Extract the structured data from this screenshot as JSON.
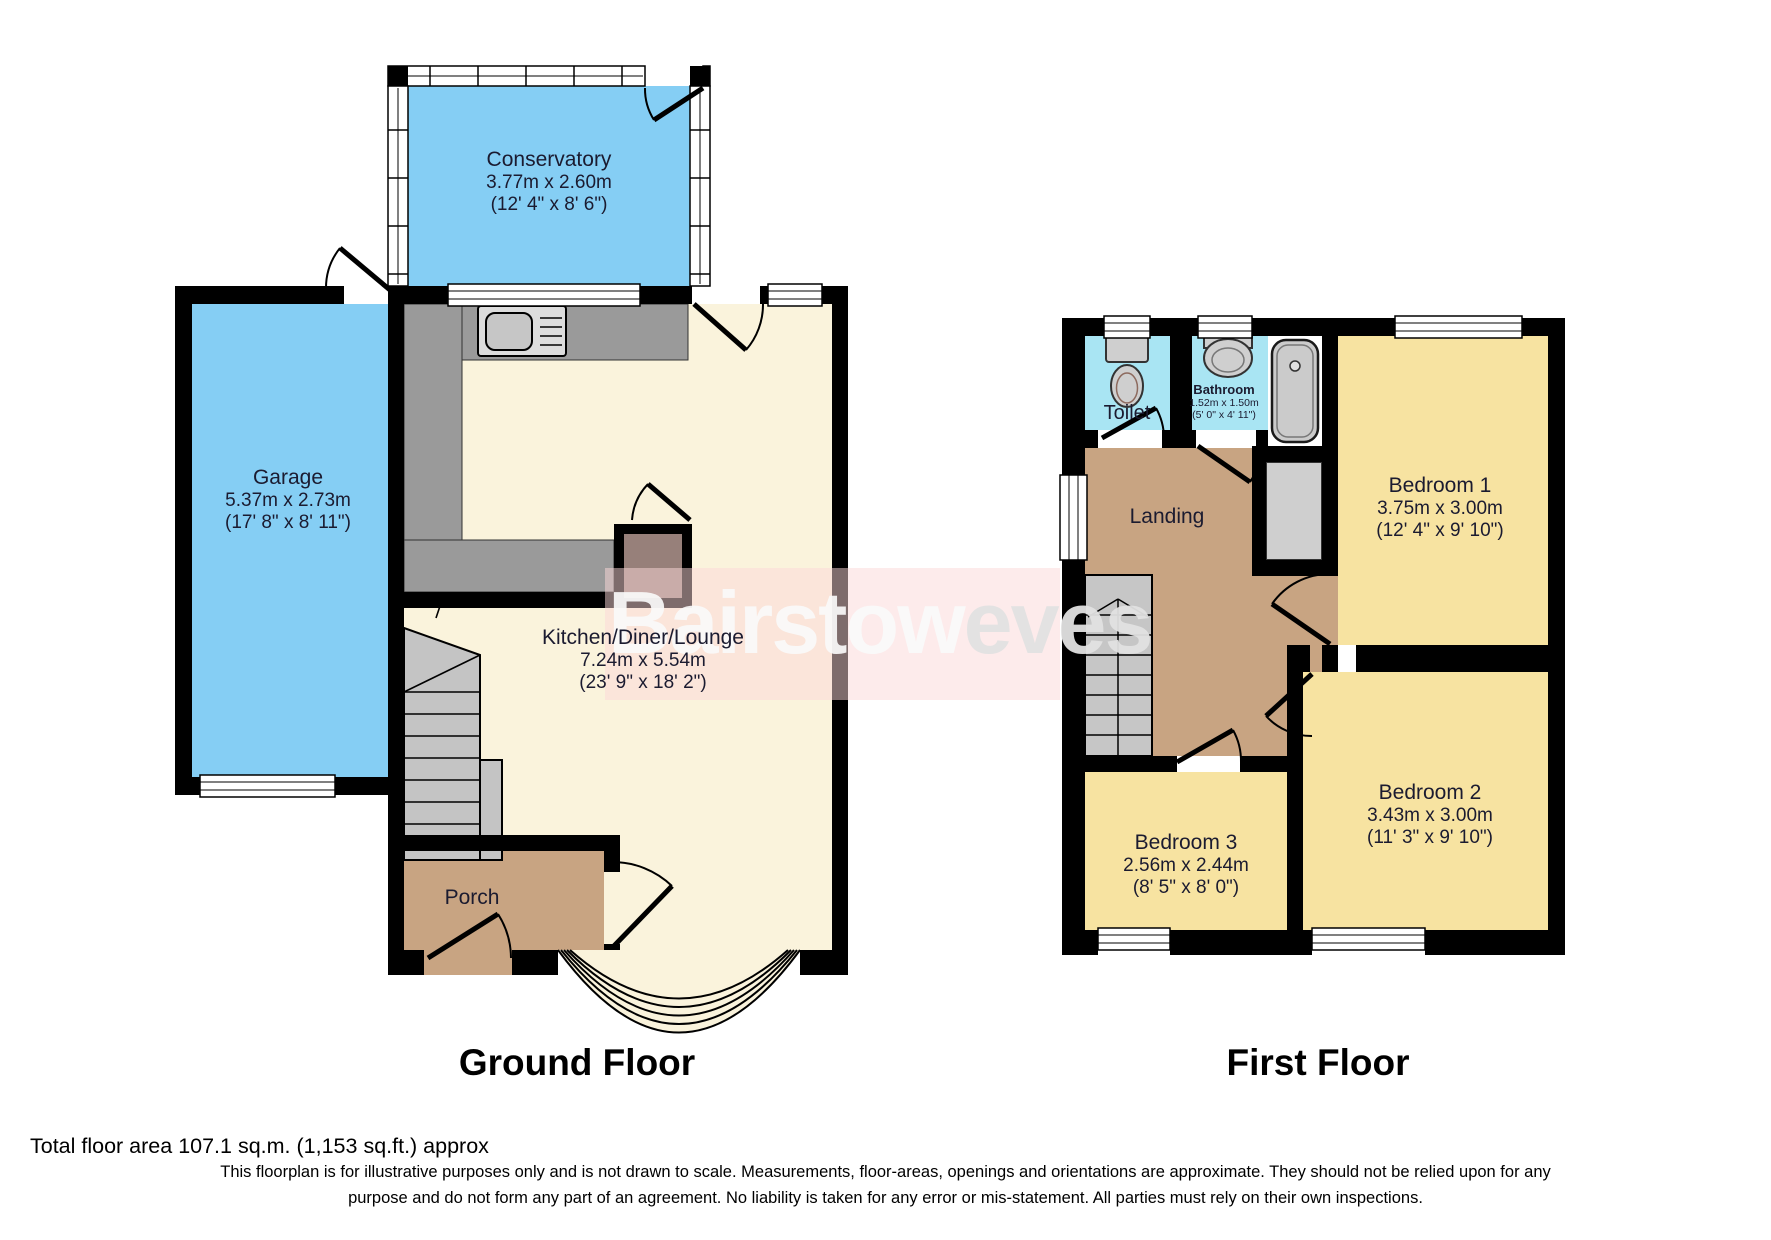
{
  "watermark": {
    "part1": "Bairstow",
    "part2": "eves"
  },
  "ground_floor": {
    "title": "Ground Floor",
    "rooms": {
      "conservatory": {
        "name": "Conservatory",
        "metric": "3.77m x 2.60m",
        "imperial": "(12' 4\" x 8' 6\")"
      },
      "garage": {
        "name": "Garage",
        "metric": "5.37m x 2.73m",
        "imperial": "(17' 8\" x 8' 11\")"
      },
      "kitchen_diner_lounge": {
        "name": "Kitchen/Diner/Lounge",
        "metric": "7.24m x 5.54m",
        "imperial": "(23' 9\" x 18' 2\")"
      },
      "porch": {
        "name": "Porch"
      }
    }
  },
  "first_floor": {
    "title": "First Floor",
    "rooms": {
      "toilet": {
        "name": "Toilet"
      },
      "bathroom": {
        "name": "Bathroom",
        "metric": "1.52m x 1.50m",
        "imperial": "(5' 0\" x 4' 11\")"
      },
      "landing": {
        "name": "Landing"
      },
      "bedroom1": {
        "name": "Bedroom 1",
        "metric": "3.75m x 3.00m",
        "imperial": "(12' 4\" x 9' 10\")"
      },
      "bedroom2": {
        "name": "Bedroom 2",
        "metric": "3.43m x 3.00m",
        "imperial": "(11' 3\" x 9' 10\")"
      },
      "bedroom3": {
        "name": "Bedroom 3",
        "metric": "2.56m x 2.44m",
        "imperial": "(8' 5\" x 8' 0\")"
      }
    }
  },
  "footer": {
    "total_area": "Total floor area 107.1 sq.m. (1,153 sq.ft.) approx",
    "disclaimer_line1": "This floorplan is for illustrative purposes only and is not drawn to scale. Measurements, floor-areas, openings and orientations are approximate. They should not be relied upon for any",
    "disclaimer_line2": "purpose and do not form any part of an agreement. No liability is taken for any error or mis-statement. All parties must rely on their own inspections."
  },
  "colors": {
    "room_blue": "#85CEF4",
    "room_cyan": "#A9E5F3",
    "room_cream": "#FAF3DC",
    "room_yellow": "#F7E3A1",
    "room_tan": "#C8A482",
    "counter_gray": "#9A9A9A",
    "stairs_gray": "#C4C4C4",
    "wall": "#000000"
  }
}
